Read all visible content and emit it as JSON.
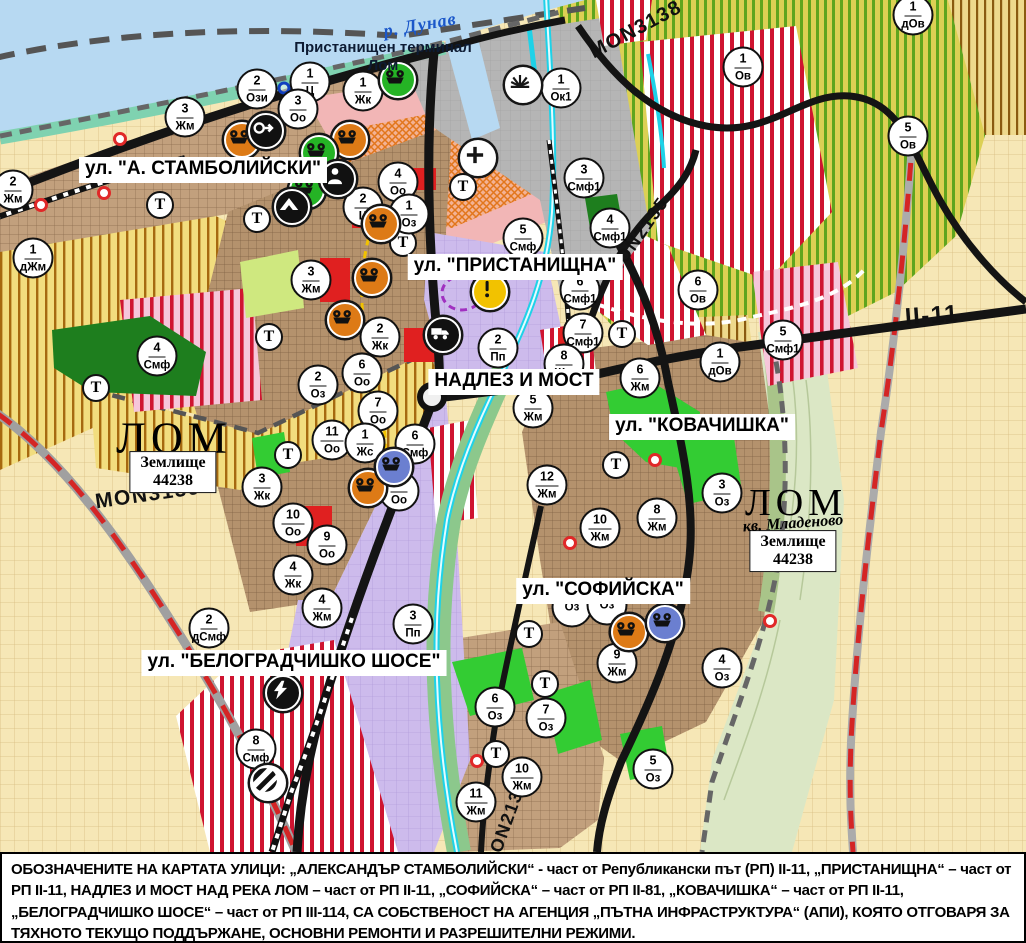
{
  "map": {
    "river_label": "р. Дунав",
    "port_terminal_label": "Пристанищен терминал Лом",
    "district_label": "кв. Младеново",
    "city_labels": [
      {
        "text": "ЛОМ",
        "x": 174,
        "y": 438,
        "size": 44
      },
      {
        "text": "ЛОМ",
        "x": 796,
        "y": 503,
        "size": 38
      }
    ],
    "land_plots": [
      {
        "line1": "Землище",
        "line2": "44238",
        "x": 173,
        "y": 472
      },
      {
        "line1": "Землище",
        "line2": "44238",
        "x": 793,
        "y": 551
      }
    ],
    "street_labels": [
      {
        "text": "ул. \"А. СТАМБОЛИЙСКИ\"",
        "x": 203,
        "y": 170
      },
      {
        "text": "ул. \"ПРИСТАНИЩНА\"",
        "x": 515,
        "y": 267
      },
      {
        "text": "НАДЛЕЗ И МОСТ",
        "x": 514,
        "y": 382
      },
      {
        "text": "ул. \"КОВАЧИШКА\"",
        "x": 702,
        "y": 427
      },
      {
        "text": "ул. \"СОФИЙСКА\"",
        "x": 603,
        "y": 591
      },
      {
        "text": "ул. \"БЕЛОГРАДЧИШКО ШОСЕ\"",
        "x": 294,
        "y": 663
      }
    ],
    "road_labels": [
      {
        "text": "MON3139",
        "x": 148,
        "y": 495,
        "rotate": -8,
        "size": 21
      },
      {
        "text": "MON3138",
        "x": 636,
        "y": 30,
        "rotate": -28,
        "size": 20
      },
      {
        "text": "MON2135",
        "x": 638,
        "y": 237,
        "rotate": -55,
        "size": 18
      },
      {
        "text": "MON2136",
        "x": 506,
        "y": 824,
        "rotate": -70,
        "size": 18
      },
      {
        "text": "II-11",
        "x": 932,
        "y": 316,
        "rotate": -4,
        "size": 24
      }
    ]
  },
  "markers": {
    "t_label": "Т",
    "zones": [
      {
        "num": "2",
        "label": "Жм",
        "x": 13,
        "y": 190
      },
      {
        "num": "1",
        "label": "дЖм",
        "x": 33,
        "y": 258
      },
      {
        "num": "3",
        "label": "Жм",
        "x": 185,
        "y": 117
      },
      {
        "num": "2",
        "label": "Ози",
        "x": 257,
        "y": 89
      },
      {
        "num": "1",
        "label": "Ц",
        "x": 310,
        "y": 82
      },
      {
        "num": "3",
        "label": "Оо",
        "x": 298,
        "y": 109
      },
      {
        "num": "1",
        "label": "Жк",
        "x": 363,
        "y": 91
      },
      {
        "num": "4",
        "label": "Оо",
        "x": 398,
        "y": 182
      },
      {
        "num": "2",
        "label": "Ц",
        "x": 363,
        "y": 207
      },
      {
        "num": "1",
        "label": "Оз",
        "x": 409,
        "y": 214
      },
      {
        "num": "1",
        "label": "Ок1",
        "x": 561,
        "y": 88
      },
      {
        "num": "3",
        "label": "Смф1",
        "x": 584,
        "y": 178
      },
      {
        "num": "4",
        "label": "Смф1",
        "x": 610,
        "y": 228
      },
      {
        "num": "5",
        "label": "Смф",
        "x": 523,
        "y": 238
      },
      {
        "num": "1",
        "label": "Ов",
        "x": 743,
        "y": 67
      },
      {
        "num": "1",
        "label": "дОв",
        "x": 913,
        "y": 15
      },
      {
        "num": "5",
        "label": "Ов",
        "x": 908,
        "y": 136
      },
      {
        "num": "6",
        "label": "Ов",
        "x": 698,
        "y": 290
      },
      {
        "num": "1",
        "label": "дОв",
        "x": 720,
        "y": 362
      },
      {
        "num": "5",
        "label": "Смф1",
        "x": 783,
        "y": 340
      },
      {
        "num": "6",
        "label": "Смф1",
        "x": 580,
        "y": 290
      },
      {
        "num": "7",
        "label": "Смф1",
        "x": 583,
        "y": 333
      },
      {
        "num": "8",
        "label": "Жм",
        "x": 564,
        "y": 364
      },
      {
        "num": "2",
        "label": "Пп",
        "x": 498,
        "y": 348
      },
      {
        "num": "5",
        "label": "Жм",
        "x": 533,
        "y": 408
      },
      {
        "num": "6",
        "label": "Жм",
        "x": 640,
        "y": 378
      },
      {
        "num": "12",
        "label": "Жм",
        "x": 547,
        "y": 485
      },
      {
        "num": "8",
        "label": "Жм",
        "x": 657,
        "y": 518
      },
      {
        "num": "3",
        "label": "Оз",
        "x": 722,
        "y": 493
      },
      {
        "num": "10",
        "label": "Жм",
        "x": 600,
        "y": 528
      },
      {
        "num": "3",
        "label": "Жм",
        "x": 311,
        "y": 280
      },
      {
        "num": "2",
        "label": "Жк",
        "x": 380,
        "y": 337
      },
      {
        "num": "6",
        "label": "Оо",
        "x": 362,
        "y": 373
      },
      {
        "num": "7",
        "label": "Оо",
        "x": 378,
        "y": 411
      },
      {
        "num": "2",
        "label": "Оз",
        "x": 318,
        "y": 385
      },
      {
        "num": "11",
        "label": "Оо",
        "x": 332,
        "y": 440
      },
      {
        "num": "1",
        "label": "Жс",
        "x": 365,
        "y": 443
      },
      {
        "num": "6",
        "label": "Смф",
        "x": 415,
        "y": 444
      },
      {
        "num": "8",
        "label": "Оо",
        "x": 399,
        "y": 491
      },
      {
        "num": "3",
        "label": "Жк",
        "x": 262,
        "y": 487
      },
      {
        "num": "4",
        "label": "Смф",
        "x": 157,
        "y": 356
      },
      {
        "num": "10",
        "label": "Оо",
        "x": 293,
        "y": 523
      },
      {
        "num": "9",
        "label": "Оо",
        "x": 327,
        "y": 545
      },
      {
        "num": "4",
        "label": "Жк",
        "x": 293,
        "y": 575
      },
      {
        "num": "4",
        "label": "Жм",
        "x": 322,
        "y": 608
      },
      {
        "num": "2",
        "label": "дСмф",
        "x": 209,
        "y": 628
      },
      {
        "num": "3",
        "label": "Пп",
        "x": 413,
        "y": 624
      },
      {
        "num": "8",
        "label": "Смф",
        "x": 256,
        "y": 749
      },
      {
        "num": "6",
        "label": "Оз",
        "x": 495,
        "y": 707
      },
      {
        "num": "7",
        "label": "Оз",
        "x": 546,
        "y": 718
      },
      {
        "num": "10",
        "label": "Жм",
        "x": 522,
        "y": 777
      },
      {
        "num": "11",
        "label": "Жм",
        "x": 476,
        "y": 802
      },
      {
        "num": "5",
        "label": "Оз",
        "x": 653,
        "y": 769
      },
      {
        "num": "9",
        "label": "Жм",
        "x": 617,
        "y": 663
      },
      {
        "num": "4",
        "label": "Оз",
        "x": 722,
        "y": 668
      },
      {
        "num": "",
        "label": "Оз",
        "x": 572,
        "y": 607
      },
      {
        "num": "",
        "label": "Оз",
        "x": 607,
        "y": 605
      }
    ],
    "transport": [
      [
        160,
        205
      ],
      [
        257,
        219
      ],
      [
        403,
        243
      ],
      [
        463,
        187
      ],
      [
        269,
        337
      ],
      [
        96,
        388
      ],
      [
        288,
        455
      ],
      [
        622,
        334
      ],
      [
        616,
        465
      ],
      [
        529,
        634
      ],
      [
        545,
        684
      ],
      [
        496,
        754
      ]
    ],
    "icons": [
      {
        "type": "factory-orange-icon",
        "x": 242,
        "y": 140
      },
      {
        "type": "factory-orange-icon",
        "x": 350,
        "y": 140
      },
      {
        "type": "factory-orange-icon",
        "x": 381,
        "y": 224
      },
      {
        "type": "factory-orange-icon",
        "x": 372,
        "y": 278
      },
      {
        "type": "factory-orange-icon",
        "x": 345,
        "y": 320
      },
      {
        "type": "factory-orange-icon",
        "x": 368,
        "y": 488
      },
      {
        "type": "factory-orange-icon",
        "x": 629,
        "y": 632
      },
      {
        "type": "factory-green-icon",
        "x": 398,
        "y": 80
      },
      {
        "type": "factory-green-icon",
        "x": 319,
        "y": 153
      },
      {
        "type": "factory-green-icon",
        "x": 307,
        "y": 190
      },
      {
        "type": "factory-blue-icon",
        "x": 394,
        "y": 467
      },
      {
        "type": "factory-blue-icon",
        "x": 665,
        "y": 623
      },
      {
        "type": "arrow-icon",
        "x": 266,
        "y": 131
      },
      {
        "type": "person-icon",
        "x": 338,
        "y": 179
      },
      {
        "type": "mountain-icon",
        "x": 292,
        "y": 207
      },
      {
        "type": "cross-icon",
        "x": 478,
        "y": 158
      },
      {
        "type": "fan-icon",
        "x": 523,
        "y": 85
      },
      {
        "type": "truck-icon",
        "x": 443,
        "y": 335
      },
      {
        "type": "lightning-icon",
        "x": 283,
        "y": 693
      },
      {
        "type": "rail-crossing-icon",
        "x": 268,
        "y": 783
      },
      {
        "type": "exclamation-icon",
        "x": 490,
        "y": 292
      }
    ],
    "red_dots": [
      [
        120,
        139
      ],
      [
        104,
        193
      ],
      [
        41,
        205
      ],
      [
        655,
        460
      ],
      [
        570,
        543
      ],
      [
        477,
        761
      ],
      [
        770,
        621
      ]
    ],
    "blue_rings": [
      [
        284,
        88
      ]
    ]
  },
  "footer": {
    "text": "ОБОЗНАЧЕНИТЕ НА КАРТАТА УЛИЦИ: „АЛЕКСАНДЪР СТАМБОЛИЙСКИ“ - част от Републикански път (РП) II-11, „ПРИСТАНИЩНА“ – част от РП II-11, НАДЛЕЗ И МОСТ НАД РЕКА ЛОМ – част от РП II-11, „СОФИЙСКА“ – част от РП II-81, „КОВАЧИШКА“ – част от РП II-11, „БЕЛОГРАДЧИШКО ШОСЕ“ – част от РП III-114, СА СОБСТВЕНОСТ НА АГЕНЦИЯ „ПЪТНА ИНФРАСТРУКТУРА“ (АПИ), КОЯТО ОТГОВАРЯ ЗА ТЯХНОТО ТЕКУЩО ПОДДЪРЖАНЕ, ОСНОВНИ РЕМОНТИ И РАЗРЕШИТЕЛНИ РЕЖИМИ."
  },
  "colors": {
    "river": "#b7d9f2",
    "vineyard_green": "#5fa51e",
    "farmland_brown": "#a6690f",
    "urban": "#bfa183",
    "industrial_purple": "#cdbbec",
    "mixed_red": "#cf1430",
    "park_green": "#1e7e1e",
    "road_black": "#141414",
    "ring_red": "#d42525",
    "channel_cyan": "#1ed2e8"
  }
}
